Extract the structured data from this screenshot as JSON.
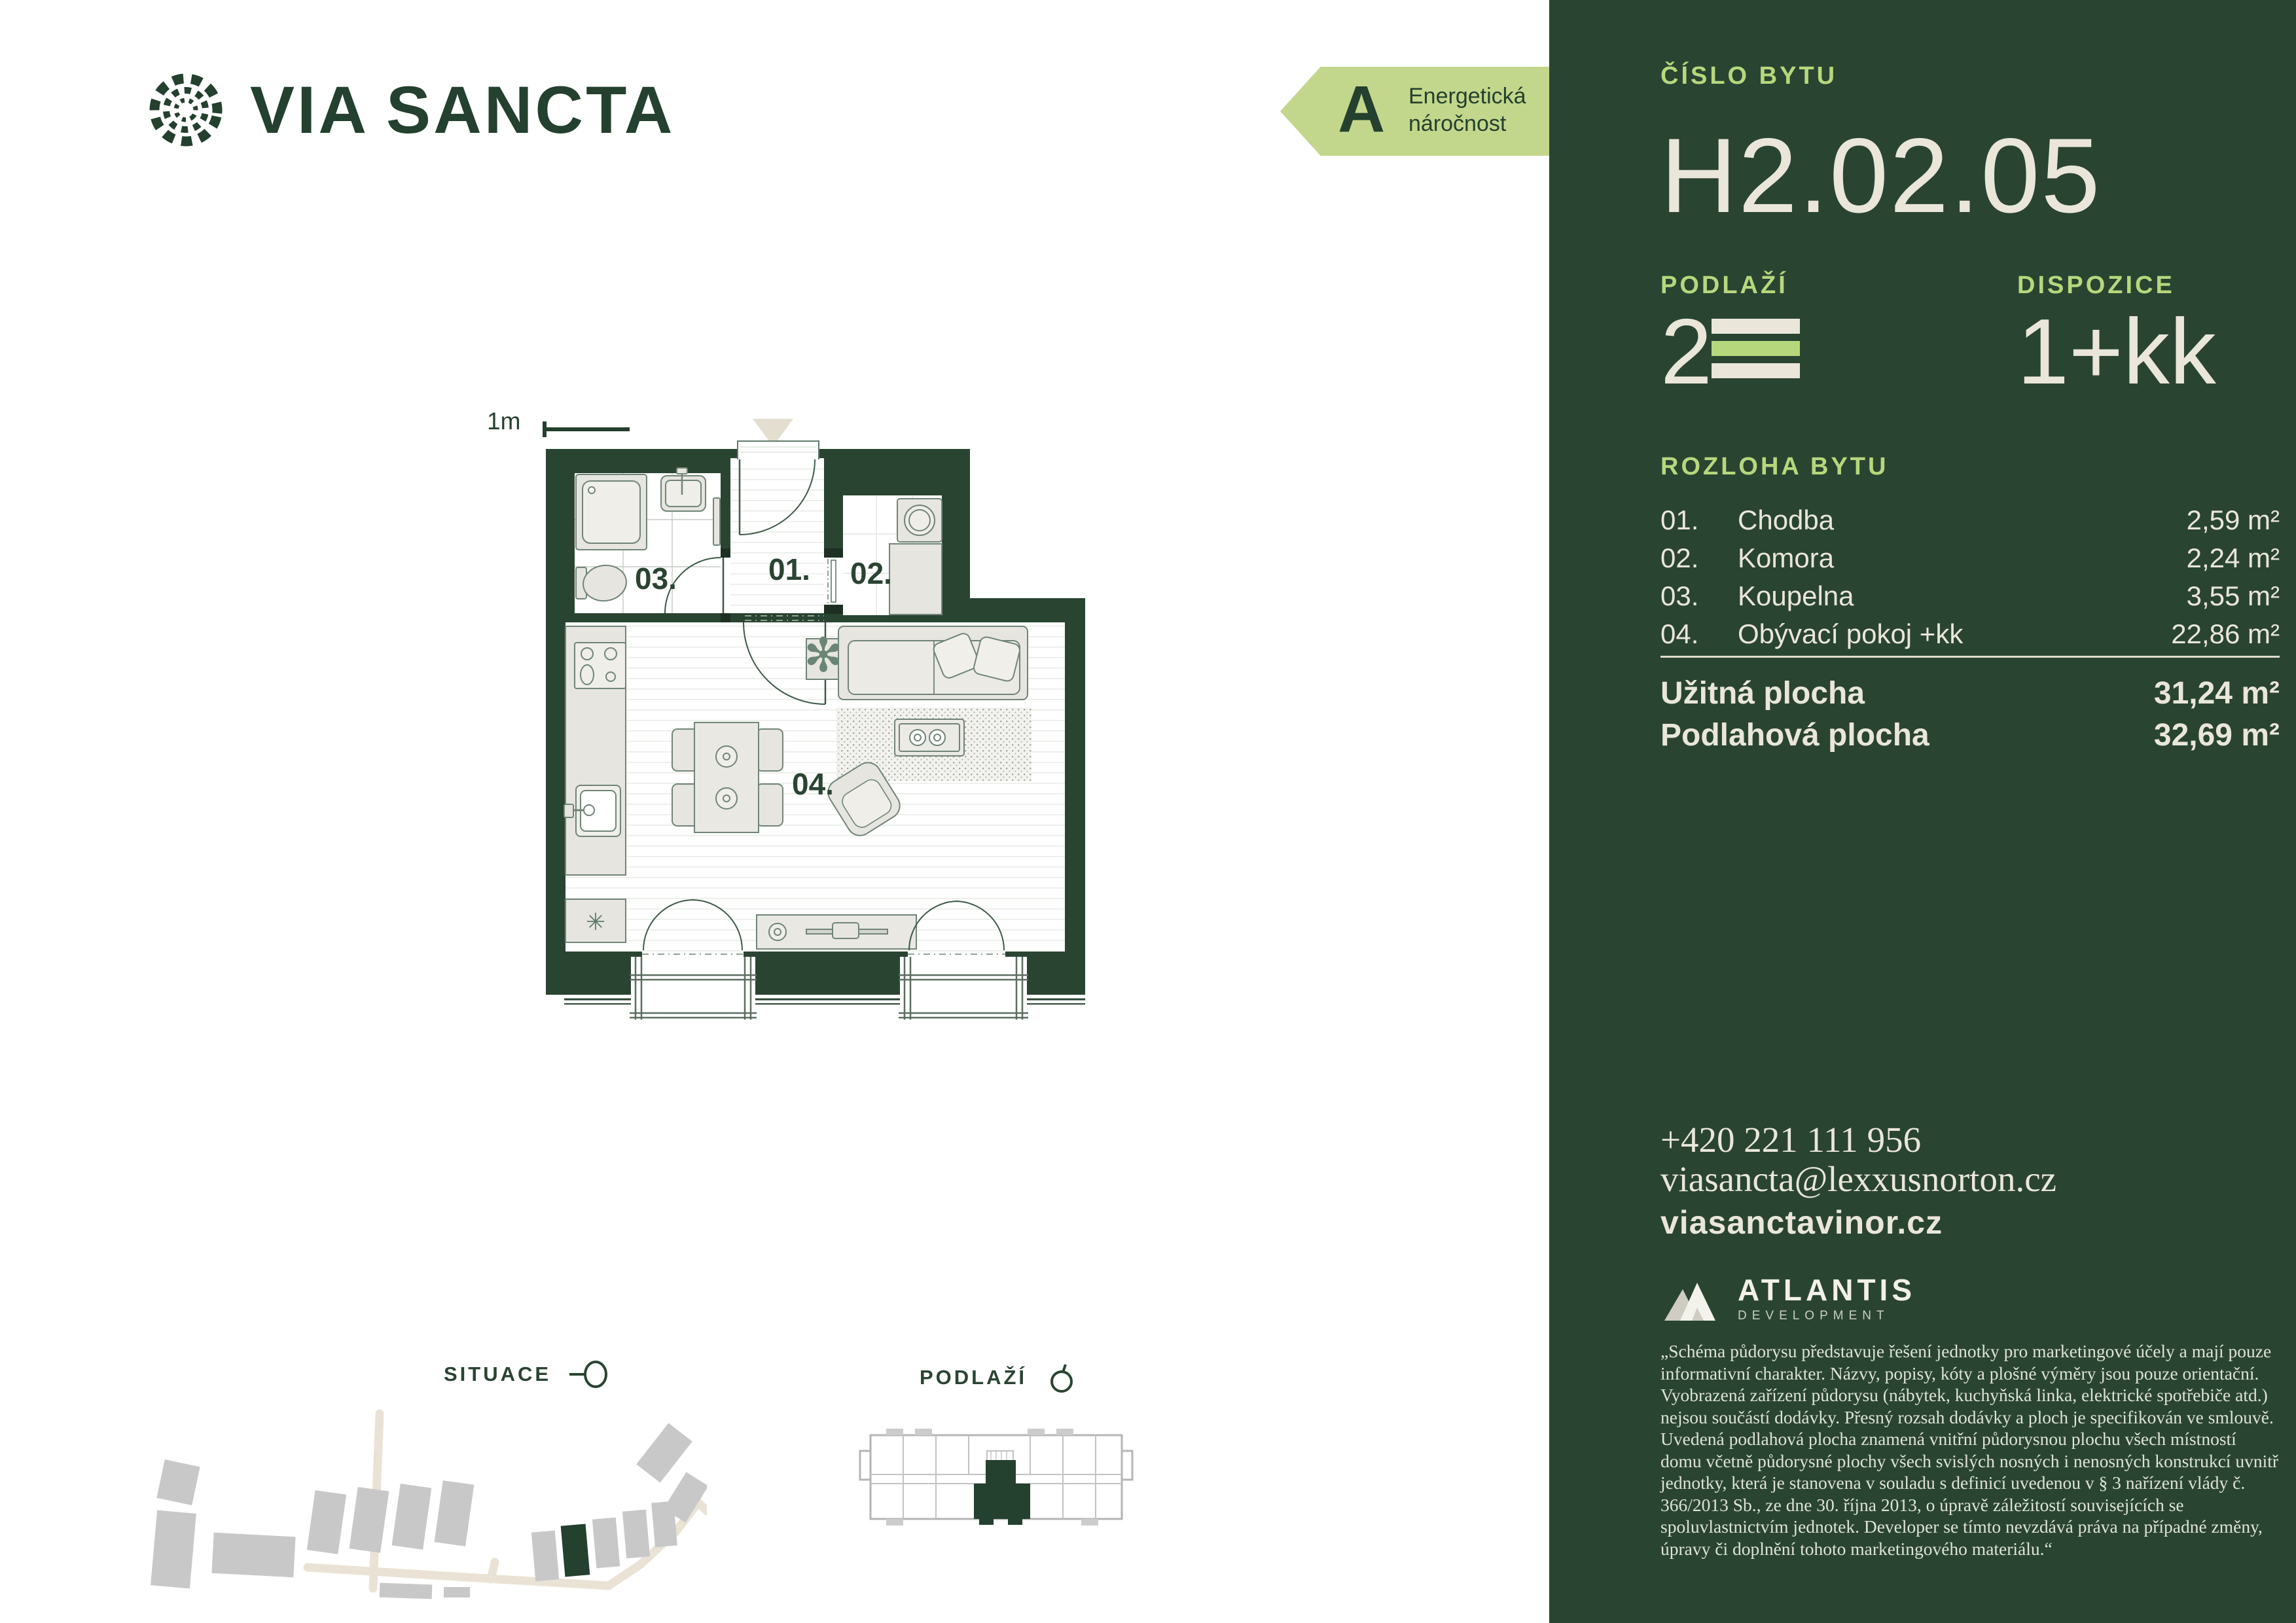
{
  "brand": {
    "via": "VIA",
    "sancta": "SANCTA"
  },
  "energy_badge": {
    "grade": "A",
    "line1": "Energetická",
    "line2": "náročnost"
  },
  "panel": {
    "unit_label": "ČÍSLO BYTU",
    "unit_number": "H2.02.05",
    "floor_label": "PODLAŽÍ",
    "floor_value": "2",
    "layout_label": "DISPOZICE",
    "layout_value": "1+kk",
    "area_label": "ROZLOHA BYTU",
    "rooms": [
      {
        "num": "01.",
        "name": "Chodba",
        "area": "2,59 m²"
      },
      {
        "num": "02.",
        "name": "Komora",
        "area": "2,24 m²"
      },
      {
        "num": "03.",
        "name": "Koupelna",
        "area": "3,55 m²"
      },
      {
        "num": "04.",
        "name": "Obývací pokoj +kk",
        "area": "22,86 m²"
      }
    ],
    "usable_label": "Užitná plocha",
    "usable_value": "31,24 m²",
    "floor_area_label": "Podlahová plocha",
    "floor_area_value": "32,69 m²",
    "phone": "+420 221 111 956",
    "email": "viasancta@lexxusnorton.cz",
    "web": "viasanctavinor.cz",
    "developer_name": "ATLANTIS",
    "developer_sub": "DEVELOPMENT",
    "disclaimer": "„Schéma půdorysu představuje řešení jednotky pro marketingové účely a mají pouze informativní charakter. Názvy, popisy, kóty a plošné výměry jsou pouze orientační. Vyobrazená zařízení půdorysu (nábytek, kuchyňská linka, elektrické spotřebiče atd.) nejsou součástí dodávky. Přesný rozsah dodávky a ploch je specifikován ve smlouvě. Uvedená podlahová plocha znamená vnitřní půdorysnou plochu všech místností domu včetně půdorysné plochy všech svislých nosných i nenosných konstrukcí uvnitř jednotky, která je stanovena v souladu s definicí uvedenou v § 3 nařízení vlády č. 366/2013 Sb., ze dne 30. října 2013, o úpravě záležitostí souvisejících se spoluvlastnictvím jednotek. Developer se tímto nevzdává práva na případné změny, úpravy či doplnění tohoto marketingového materiálu.“"
  },
  "floorplan": {
    "scale_label": "1m",
    "room1": "01.",
    "room2": "02.",
    "room3": "03.",
    "room4": "04.",
    "kitchen_symbol": "✳",
    "plant_symbol": "✻"
  },
  "maps": {
    "situace_label": "SITUACE",
    "podlazi_label": "PODLAŽÍ"
  },
  "colors": {
    "dark_green": "#2a4432",
    "light_green": "#b7d77c",
    "badge_green": "#c3d78c",
    "cream": "#eae6da",
    "furniture_fill": "#e6e5df",
    "map_gray": "#c8c8c8",
    "road_beige": "#eae3d5"
  }
}
